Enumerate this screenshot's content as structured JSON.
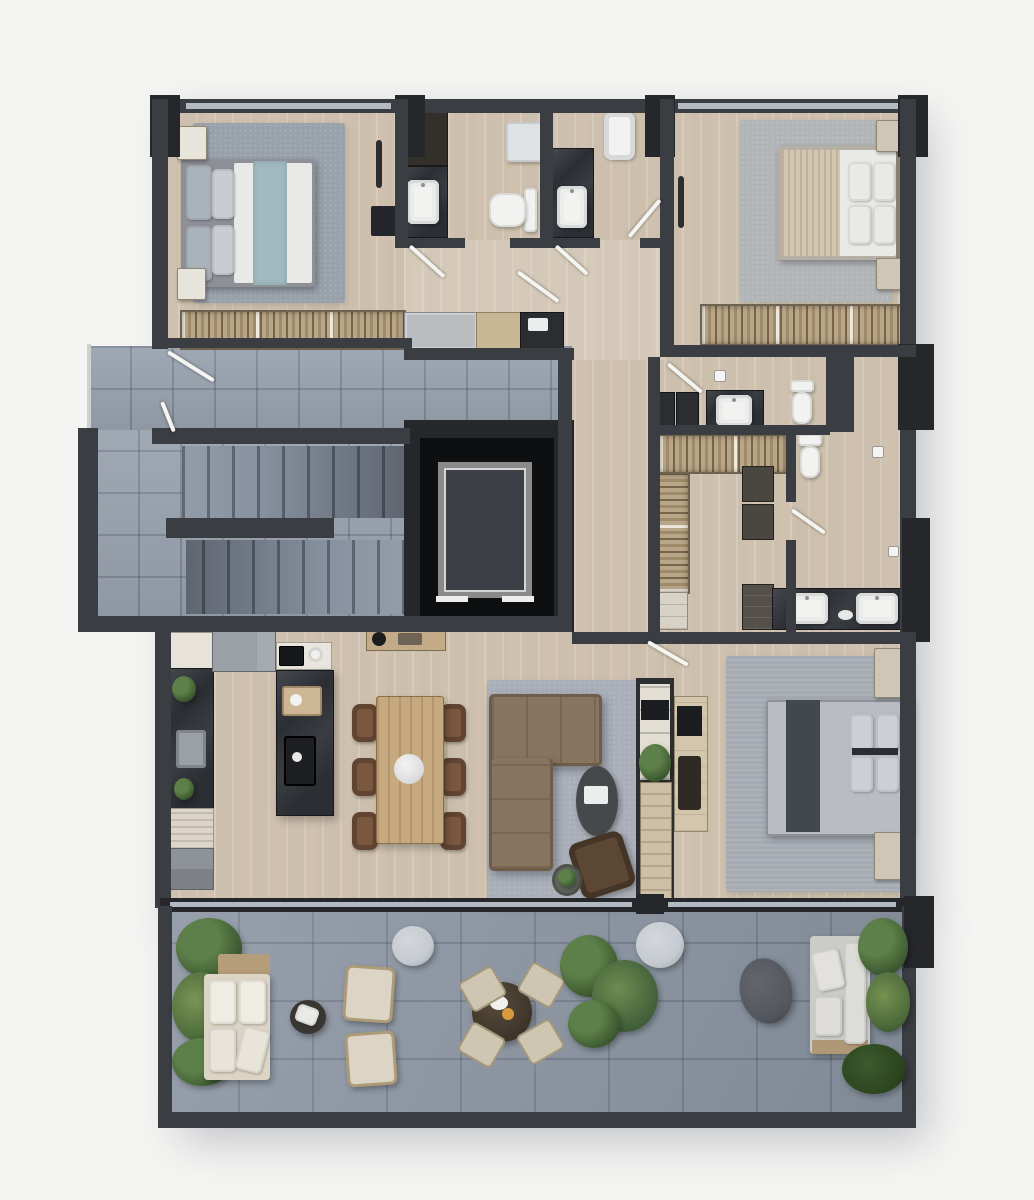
{
  "meta": {
    "title": "3D rendered floor plan — three-bedroom apartment with terrace, top-down view",
    "render_style": "photorealistic top view, no text labels"
  },
  "palette": {
    "bg": "#f4f4f2",
    "wall": "#3a3d42",
    "wallDeep": "#26272b",
    "shaft": "#0e0f11",
    "glass": "#b4bac1",
    "wood": "#d6cab8",
    "woodLight": "#ded4c5",
    "tileHall": "#97a1ad",
    "tileBalcony": "#8b95a2",
    "stairTread": "#87919f",
    "marble": "#2b2e33",
    "fixtureWhite": "#f2f3f1",
    "rug1": "#99a1aa",
    "rug2": "#b2b5b8",
    "rug3": "#a6abb3",
    "rugLiving": "#a9aeb8",
    "bedBlue": "#9fbac0",
    "bedWhite": "#e9e9e7",
    "duvetTan": "#d3c7b2",
    "bedGray": "#b9bdc3",
    "sofaBrown": "#87755f",
    "sofaEdge": "#6e5d4a",
    "chairBrown": "#7a573f",
    "tableWood": "#c7a97f",
    "closetBase": "#b7a687",
    "outBeige": "#dcd5c6",
    "outGray": "#cbcbc8",
    "plant": "#5d7f49",
    "plantDark": "#39562e",
    "poufGray": "#c6cbd1",
    "liftCar": "#3c3f45"
  },
  "rooms": {
    "bedroom1": {
      "name": "Bedroom 1 (top left)",
      "furniture": [
        "double bed with blue runner",
        "gray rug",
        "two nightstands",
        "open wardrobe with clothes",
        "desk",
        "clothes rail"
      ]
    },
    "bathroom1": {
      "name": "Bathroom 1",
      "furniture": [
        "stone vanity with sink",
        "toilet",
        "shower",
        "tall cabinet"
      ]
    },
    "bathroom2": {
      "name": "Bathroom 2",
      "furniture": [
        "stone vanity with sink",
        "bathtub"
      ]
    },
    "bedroom2": {
      "name": "Bedroom 2 (top right)",
      "furniture": [
        "double bed with tan throw",
        "gray rug",
        "two nightstands",
        "open wardrobe with clothes",
        "coat rail"
      ]
    },
    "entry_hall": {
      "name": "Entry corridor",
      "furniture": [
        "sideboard with tray"
      ]
    },
    "stair_core": {
      "name": "Common staircase",
      "furniture": [
        "upper flight",
        "lower flight",
        "tiled landing"
      ]
    },
    "elevator": {
      "name": "Elevator shaft",
      "furniture": [
        "elevator car"
      ]
    },
    "bathroom3": {
      "name": "Bathroom 3 / laundry",
      "furniture": [
        "washer and dryer",
        "vanity with sink",
        "toilet"
      ]
    },
    "walk_in_closet": {
      "name": "Walk-in closet",
      "furniture": [
        "hanging rail top",
        "hanging rail left",
        "shelf stacks",
        "drawer units"
      ]
    },
    "bathroom4": {
      "name": "En-suite bathroom",
      "furniture": [
        "toilet",
        "double-sink stone vanity"
      ]
    },
    "kitchen": {
      "name": "Kitchen",
      "furniture": [
        "tall cabinet run",
        "stone worktop with sink",
        "fridge",
        "cooktop counter",
        "appliance counter",
        "stone island with coffee machine"
      ]
    },
    "dining": {
      "name": "Dining area",
      "furniture": [
        "wooden table for six",
        "six leather chairs",
        "round centerpiece"
      ]
    },
    "living": {
      "name": "Living room",
      "furniture": [
        "L-shaped brown sofa",
        "oval coffee table",
        "armchair",
        "round side table",
        "shelving partition with TV"
      ]
    },
    "bedroom3": {
      "name": "Bedroom 3 (bottom right)",
      "furniture": [
        "double bed with dark runner",
        "large gray rug",
        "two nightstands",
        "media console with TV"
      ]
    },
    "balcony": {
      "name": "Terrace / balcony",
      "furniture": [
        "outdoor sofa with cushions",
        "round coffee table",
        "two lounge chairs",
        "bistro table with four chairs",
        "large potted plants",
        "two round poufs",
        "oval pouf",
        "outdoor lounge set",
        "planting beds"
      ]
    }
  }
}
